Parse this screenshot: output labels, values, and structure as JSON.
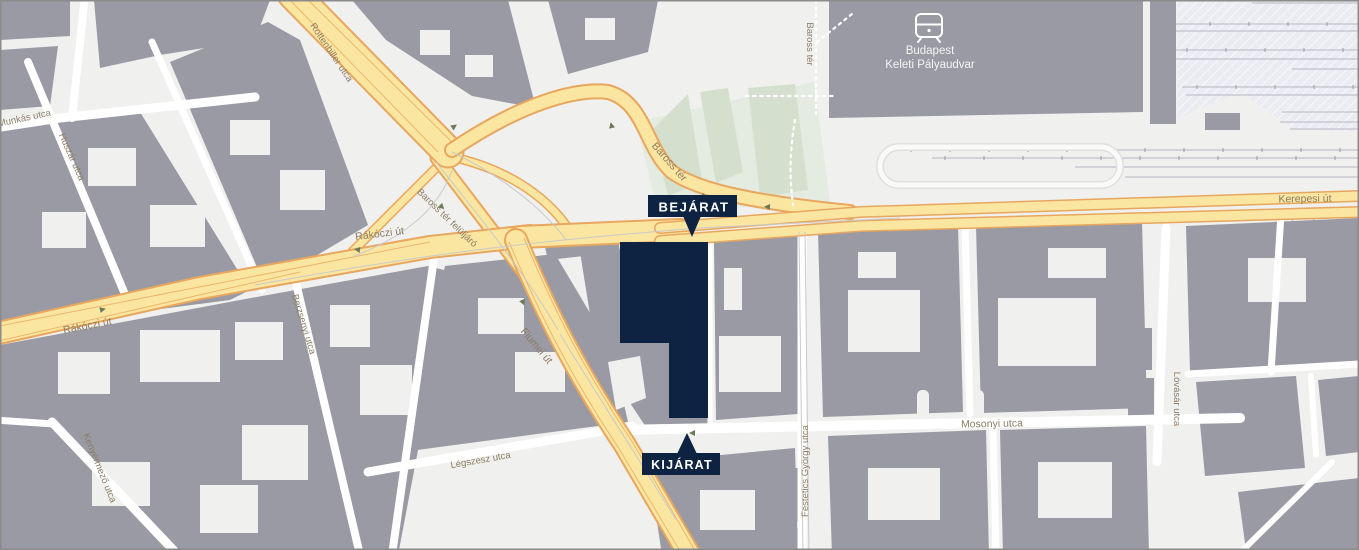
{
  "map": {
    "type": "static-city-map",
    "city_area": "Budapest, Baross tér / Keleti pályaudvar környéke",
    "colors": {
      "background": "#f0f0ee",
      "building_gray": "#999aa3",
      "road_yellow": "#fae6a0",
      "road_casing_orange": "#e8a65e",
      "park_green": "#d4e0cd",
      "railway_area": "#ebecf2",
      "street_label_brown": "#8c7c64",
      "highlight_navy": "#0e2342",
      "marker_text_white": "#ffffff"
    },
    "markers": {
      "entrance": {
        "label": "BEJÁRAT"
      },
      "exit": {
        "label": "KIJÁRAT"
      }
    },
    "station": {
      "icon": "tram-icon",
      "name_line1": "Budapest",
      "name_line2": "Keleti Pályaudvar"
    },
    "street_labels": [
      {
        "text": "Munkás utca"
      },
      {
        "text": "Huszár utca"
      },
      {
        "text": "Rákóczi út"
      },
      {
        "text": "Rákóczi út"
      },
      {
        "text": "Baross tér felüljáró"
      },
      {
        "text": "Rottenbiller utca"
      },
      {
        "text": "Baross tér"
      },
      {
        "text": "Baross tér"
      },
      {
        "text": "Kerepesi út"
      },
      {
        "text": "Fiumei út"
      },
      {
        "text": "Mosonyi utca"
      },
      {
        "text": "Festetics György utca"
      },
      {
        "text": "Lóvásár utca"
      },
      {
        "text": "Légszesz utca"
      },
      {
        "text": "Kenyérmező utca"
      },
      {
        "text": "Berzsenyi utca"
      }
    ]
  }
}
